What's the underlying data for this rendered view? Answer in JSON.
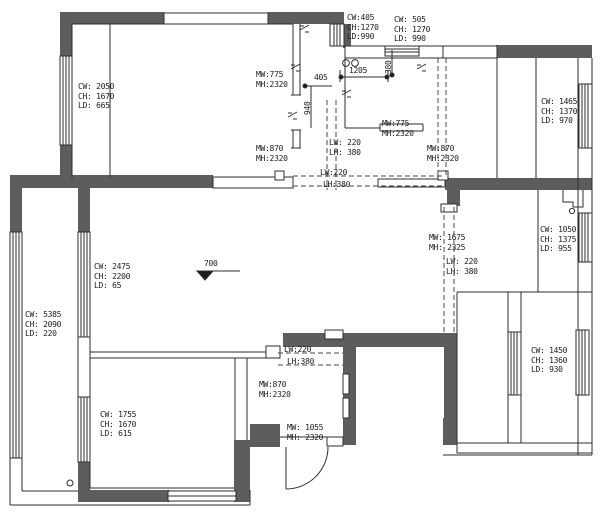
{
  "colors": {
    "wall": "#5d5d5d",
    "line": "#2e2e2e",
    "text": "#1c1c1c"
  },
  "ann": {
    "win_tl": {
      "l1": "CW: 2050",
      "l2": "CH: 1670",
      "l3": "LD: 665"
    },
    "door_tl_upper": {
      "l1": "MW:775",
      "l2": "MH:2320"
    },
    "door_tl_lower": {
      "l1": "MW:870",
      "l2": "MH:2320"
    },
    "win_kitchen_a": {
      "l1": "CW:405",
      "l2": "CH:1270",
      "l3": "LD:990"
    },
    "win_kitchen_b": {
      "l1": "CW: 505",
      "l2": "CH: 1270",
      "l3": "LD: 990"
    },
    "door_kitchen": {
      "l1": "MW:775",
      "l2": "MH:2320"
    },
    "door_hall": {
      "l1": "MW:870",
      "l2": "MH:2320"
    },
    "win_tr": {
      "l1": "CW: 1465",
      "l2": "CH: 1370",
      "l3": "LD: 970"
    },
    "beam_center_v": {
      "l1": "LW: 220",
      "l2": "LH: 380"
    },
    "beam_center_h1": {
      "l1": "LW:220"
    },
    "beam_center_h2": {
      "l1": "LH:380"
    },
    "win_balcony_inner": {
      "l1": "CW: 2475",
      "l2": "CH: 2200",
      "l3": "LD: 65"
    },
    "win_balcony_outer": {
      "l1": "CW: 5385",
      "l2": "CH: 2090",
      "l3": "LD: 220"
    },
    "door_closet": {
      "l1": "MW: 1675",
      "l2": "MH: 2325"
    },
    "beam_right": {
      "l1": "LW: 220",
      "l2": "LH: 380"
    },
    "win_right_mid": {
      "l1": "CW: 1050",
      "l2": "CH: 1375",
      "l3": "LD: 955"
    },
    "win_bottom_right": {
      "l1": "CW: 1450",
      "l2": "CH: 1360",
      "l3": "LD: 930"
    },
    "win_bottom_left": {
      "l1": "CW: 1755",
      "l2": "CH: 1670",
      "l3": "LD: 615"
    },
    "door_bottom_left": {
      "l1": "MW:870",
      "l2": "MH:2320"
    },
    "door_entry": {
      "l1": "MW: 1055",
      "l2": "MH: 2320"
    },
    "beam_bl_1": {
      "l1": "LW:220"
    },
    "beam_bl_2": {
      "l1": "LH:380"
    }
  },
  "dims": {
    "len_1205": "1205",
    "len_405": "405",
    "len_940": "940",
    "len_380": "380"
  },
  "elevation": {
    "value": "700"
  }
}
